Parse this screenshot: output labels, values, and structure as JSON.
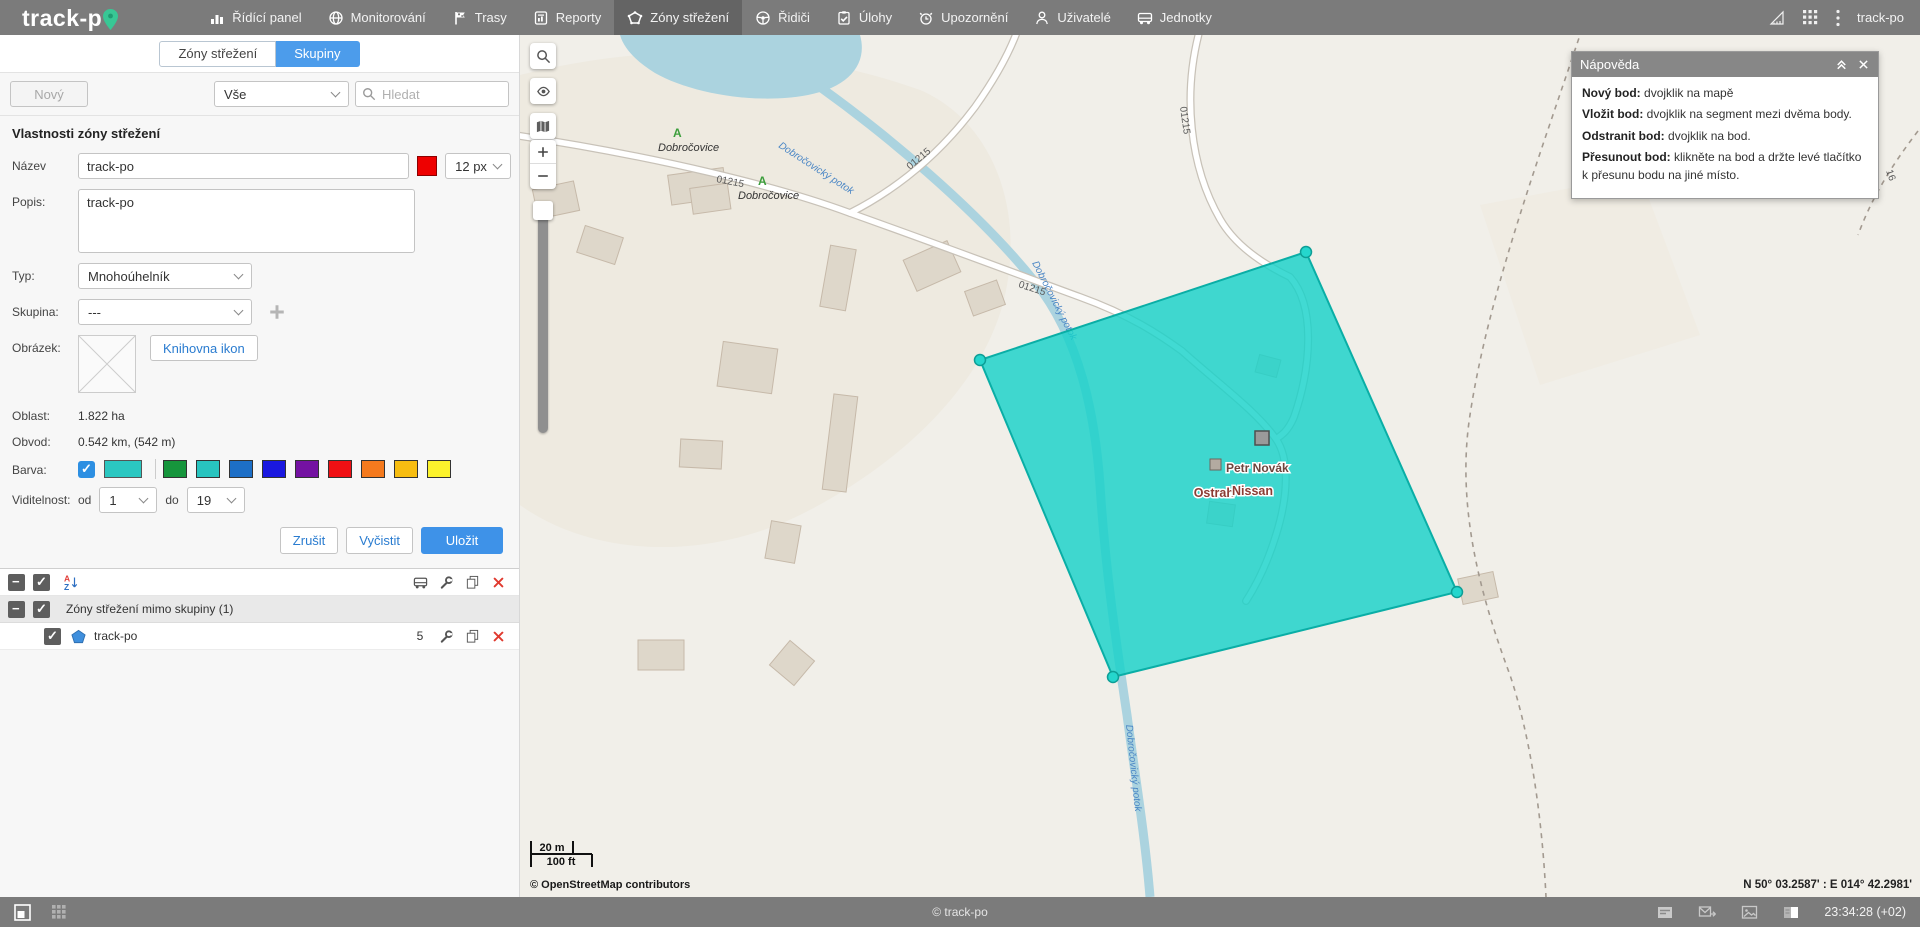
{
  "topbar": {
    "logo_text": "track-p",
    "items": [
      {
        "label": "Řídící panel",
        "icon": "dashboard-icon"
      },
      {
        "label": "Monitorování",
        "icon": "globe-icon"
      },
      {
        "label": "Trasy",
        "icon": "flag-icon"
      },
      {
        "label": "Reporty",
        "icon": "report-icon"
      },
      {
        "label": "Zóny střežení",
        "icon": "polygon-icon",
        "active": true
      },
      {
        "label": "Řidiči",
        "icon": "steering-wheel-icon"
      },
      {
        "label": "Úlohy",
        "icon": "tasks-icon"
      },
      {
        "label": "Upozornění",
        "icon": "alarm-icon"
      },
      {
        "label": "Uživatelé",
        "icon": "user-icon"
      },
      {
        "label": "Jednotky",
        "icon": "truck-icon"
      }
    ],
    "right_icons": [
      "ruler-icon",
      "apps-grid-icon",
      "kebab-menu-icon"
    ],
    "user": "track-po"
  },
  "sidebar": {
    "tabs": [
      {
        "label": "Zóny střežení",
        "active": false
      },
      {
        "label": "Skupiny",
        "active": true
      }
    ],
    "new_button": "Nový",
    "filter_value": "Vše",
    "search_placeholder": "Hledat",
    "form": {
      "title": "Vlastnosti zóny střežení",
      "name_label": "Název",
      "name_value": "track-po",
      "name_color": "#ee0000",
      "line_width_value": "12 px",
      "description_label": "Popis:",
      "description_value": "track-po",
      "type_label": "Typ:",
      "type_value": "Mnohoúhelník",
      "group_label": "Skupina:",
      "group_value": "---",
      "image_label": "Obrázek:",
      "icon_library_button": "Knihovna ikon",
      "area_label": "Oblast:",
      "area_value": "1.822 ha",
      "perimeter_label": "Obvod:",
      "perimeter_value": "0.542 km, (542 m)",
      "color_label": "Barva:",
      "current_color": "#2bc7c1",
      "palette": [
        "#16953c",
        "#28c4bf",
        "#1d6fc7",
        "#1a18e0",
        "#7412a2",
        "#f01014",
        "#f57a1e",
        "#f7bd11",
        "#fcf32c"
      ],
      "visibility_label": "Viditelnost:",
      "visibility_from_label": "od",
      "visibility_from_value": "1",
      "visibility_to_label": "do",
      "visibility_to_value": "19",
      "cancel_button": "Zrušit",
      "clear_button": "Vyčistit",
      "save_button": "Uložit"
    },
    "list": {
      "header_icons": [
        "truck-icon",
        "wrench-icon",
        "copy-icon",
        "delete-icon"
      ],
      "group_row_label": "Zóny střežení mimo skupiny (1)",
      "item": {
        "name": "track-po",
        "points": "5"
      }
    }
  },
  "map": {
    "place_labels": [
      "Dobročovice",
      "Dobročovice"
    ],
    "road_labels": [
      "01215",
      "01215",
      "01215",
      "01215"
    ],
    "partial_road_label": "16",
    "stream_labels": [
      "Dobročovický potok",
      "Dobročovický potok",
      "Dobročovický potok"
    ],
    "marker_labels": [
      "A",
      "A"
    ],
    "poi_labels": [
      "Petr Novák",
      "Ostrah",
      "Nissan"
    ],
    "polygon": {
      "fill": "#17d2c9",
      "stroke": "#0aaea6",
      "points_count": "5"
    },
    "controls": [
      "search-icon",
      "eye-icon",
      "layers-icon",
      "zoom-in",
      "zoom-out",
      "zoom-slider"
    ],
    "scale_metric": "20 m",
    "scale_imperial": "100 ft",
    "attribution": "© OpenStreetMap contributors",
    "coordinates": "N 50° 03.2587' : E 014° 42.2981'"
  },
  "help": {
    "title": "Nápověda",
    "items": [
      {
        "term": "Nový bod:",
        "desc": "dvojklik na mapě"
      },
      {
        "term": "Vložit bod:",
        "desc": "dvojklik na segment mezi dvěma body."
      },
      {
        "term": "Odstranit bod:",
        "desc": "dvojklik na bod."
      },
      {
        "term": "Přesunout bod:",
        "desc": "klikněte na bod a držte levé tlačítko k přesunu bodu na jiné místo."
      }
    ]
  },
  "bottombar": {
    "left_icons": [
      "window-icon",
      "grid-icon"
    ],
    "copyright": "© track-po",
    "right_icons": [
      "panel-icon",
      "mail-forward-icon",
      "image-icon",
      "sidebar-toggle-icon"
    ],
    "time": "23:34:28 (+02)"
  }
}
